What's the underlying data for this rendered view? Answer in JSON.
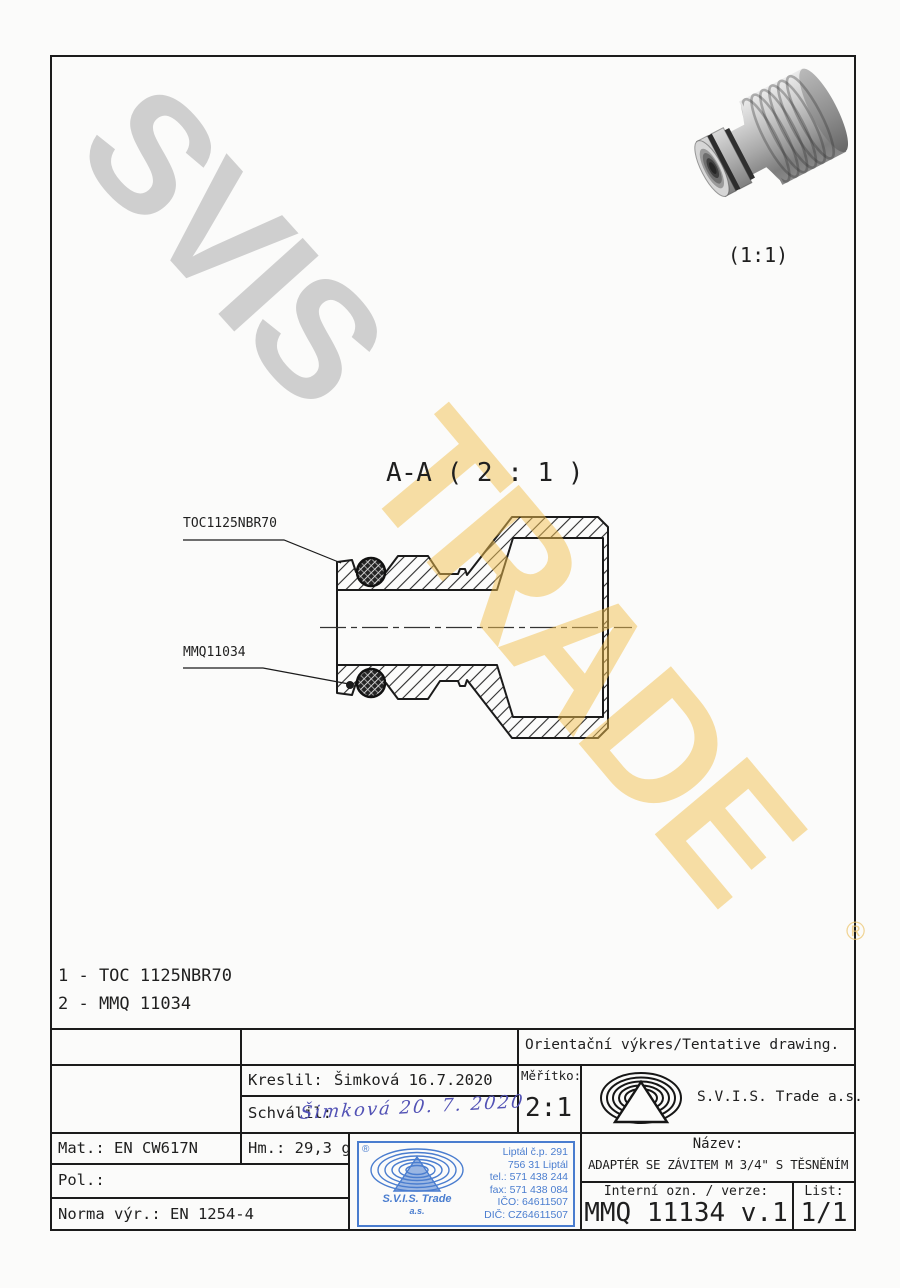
{
  "watermarks": {
    "gray_text": "SVIS",
    "yellow_text": "TRADE",
    "registered_symbol": "®"
  },
  "preview_3d": {
    "scale_label": "(1:1)"
  },
  "section": {
    "title": "A-A ( 2 : 1 )",
    "oring_label": "TOC1125NBR70",
    "body_label": "MMQ11034"
  },
  "parts_list": {
    "item1": "1 - TOC 1125NBR70",
    "item2": "2 - MMQ 11034"
  },
  "title_block": {
    "tentative": "Orientační výkres/Tentative drawing.",
    "kreslil_label": "Kreslil:",
    "kreslil_value": "Šimková 16.7.2020",
    "schvalil_label": "Schválil:",
    "schvalil_signature": "Šimková 20. 7. 2020",
    "meritko_label": "Měřítko:",
    "meritko_value": "2:1",
    "company_name": "S.V.I.S. Trade a.s.",
    "mat": "Mat.: EN CW617N",
    "hm": "Hm.: 29,3 g",
    "pol": "Pol.:",
    "norma": "Norma výr.: EN 1254-4",
    "nazev_label": "Název:",
    "nazev_value": "ADAPTÉR SE ZÁVITEM M 3/4\" S TĚSNĚNÍM",
    "interni_label": "Interní ozn. / verze:",
    "interni_value": "MMQ 11134 v.1",
    "list_label": "List:",
    "list_value": "1/1"
  },
  "stamp": {
    "registered": "®",
    "company_line1": "S.V.I.S. Trade",
    "company_line2": "a.s.",
    "address": [
      "Liptál č.p. 291",
      "756 31 Liptál",
      "tel.: 571 438 244",
      "fax: 571 438 084",
      "IČO: 64611507",
      "DIČ: CZ64611507"
    ]
  },
  "colors": {
    "line": "#1b1b1b",
    "stamp_blue": "#4a7dcf",
    "watermark_gray": "#c5c5c5",
    "watermark_yellow": "#f3c050",
    "signature_blue": "#5252b5"
  }
}
